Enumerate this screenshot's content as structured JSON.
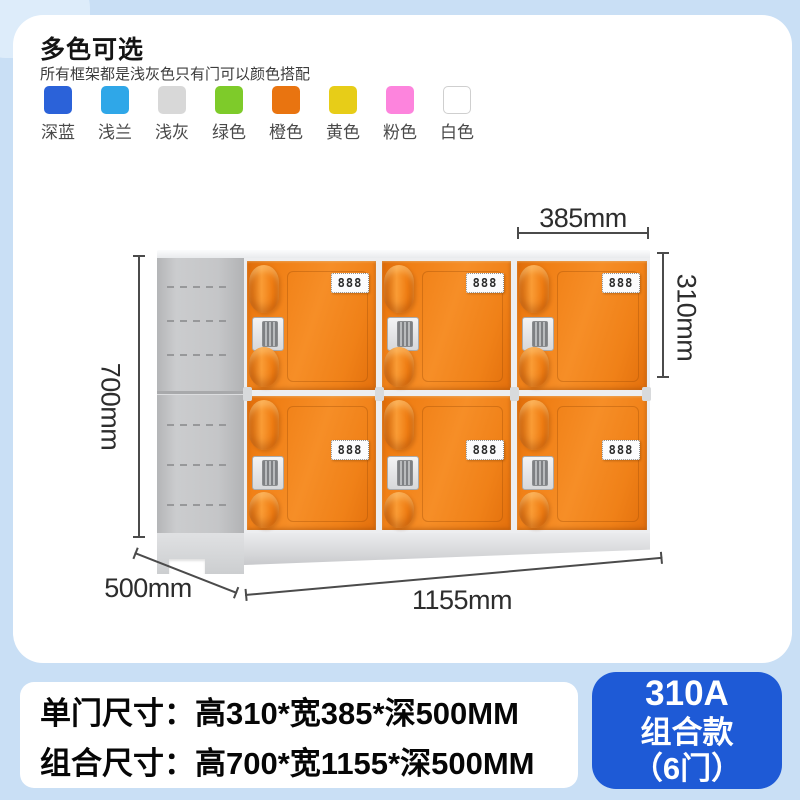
{
  "header": {
    "title": "多色可选",
    "subtitle": "所有框架都是浅灰色只有门可以颜色搭配",
    "swatches": [
      {
        "label": "深蓝",
        "color": "#2b62d9"
      },
      {
        "label": "浅兰",
        "color": "#2fa7e8"
      },
      {
        "label": "浅灰",
        "color": "#d8d8d8"
      },
      {
        "label": "绿色",
        "color": "#7ecb2a"
      },
      {
        "label": "橙色",
        "color": "#e97410"
      },
      {
        "label": "黄色",
        "color": "#e7cd18"
      },
      {
        "label": "粉色",
        "color": "#fd84dd"
      },
      {
        "label": "白色",
        "color": "#ffffff"
      }
    ]
  },
  "diagram": {
    "door_label": "888",
    "dimensions": {
      "door_width": "385mm",
      "door_height": "310mm",
      "total_height": "700mm",
      "depth": "500mm",
      "total_width": "1155mm"
    }
  },
  "specs": {
    "line1": "单门尺寸：高310*宽385*深500MM",
    "line2": "组合尺寸：高700*宽1155*深500MM"
  },
  "model": {
    "code": "310A",
    "name": "组合款",
    "doors": "（6门）"
  },
  "colors": {
    "accent_blue": "#1e5ad6",
    "background_blue": "#c9dff5",
    "door_orange": "#f08118"
  }
}
